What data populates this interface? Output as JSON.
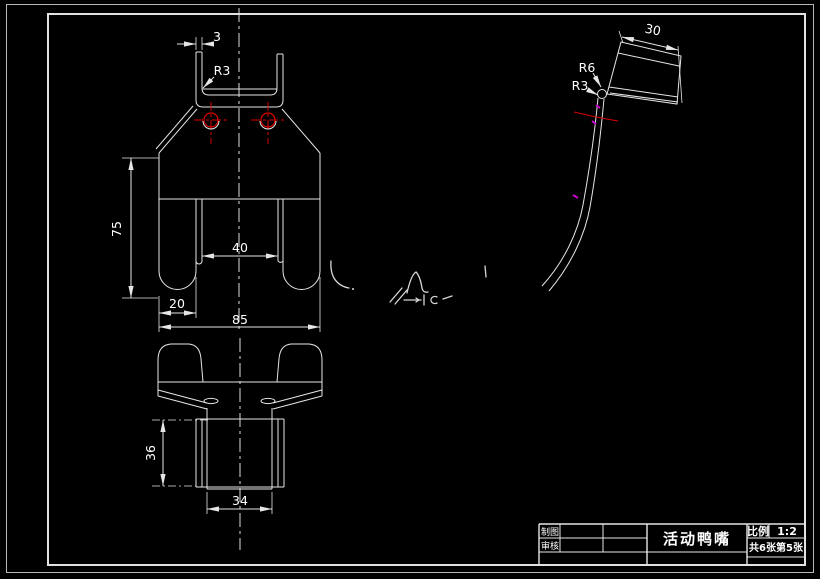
{
  "drawing": {
    "type": "CAD engineering drawing",
    "part_views": [
      "front-view",
      "bottom-view",
      "side-profile-view"
    ]
  },
  "views": {
    "front": {
      "dims": {
        "wall_thickness": "3",
        "corner_radius": "R3",
        "body_height": "75",
        "center_gap": "40",
        "finger_width": "20",
        "total_width": "85"
      }
    },
    "bottom": {
      "dims": {
        "block_height": "36",
        "block_width": "34"
      }
    },
    "side": {
      "dims": {
        "head_width": "30",
        "radius_outer": "R6",
        "radius_inner": "R3"
      }
    }
  },
  "title_block": {
    "drafter_label": "制图",
    "checker_label": "审核",
    "part_name": "活动鸭嘴",
    "scale_label": "比例",
    "scale_value": "1:2",
    "sheet_info": "共6张第5张"
  },
  "colors": {
    "background": "#000000",
    "line": "#e6e6e6",
    "frame": "#b8b8b8",
    "centerline_red": "#d90000",
    "mark_magenta": "#cc00cc",
    "text": "#ffffff"
  }
}
